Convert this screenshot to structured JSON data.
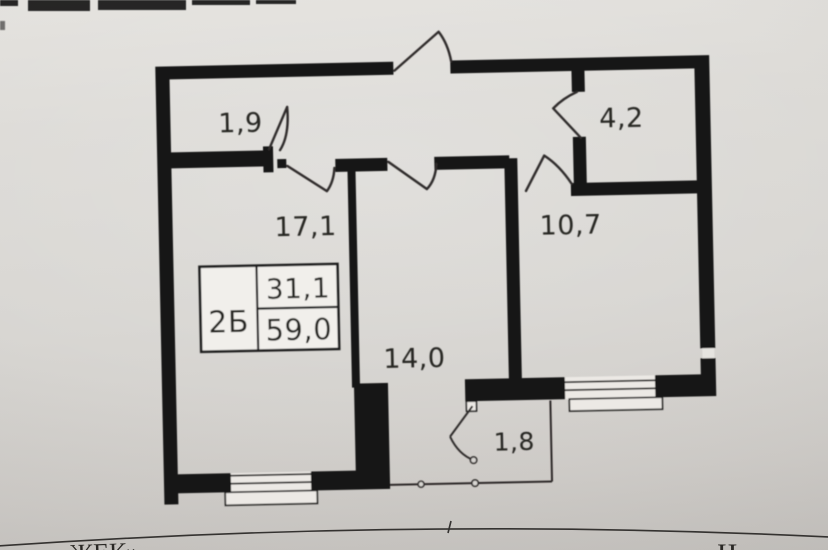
{
  "floorplan": {
    "unit": {
      "label": "2Б",
      "area_living": "31,1",
      "area_total": "59,0"
    },
    "rooms": {
      "storage": "1,9",
      "wardrobe": "4,2",
      "living": "17,1",
      "bedroom": "10,7",
      "kitchen": "14,0",
      "balcony": "1,8"
    },
    "page_text": {
      "bottom_left": "ЖЕК»",
      "bottom_right": "«Чи"
    },
    "colors": {
      "wall": "#161616",
      "paper": "#d8d6d2",
      "ink": "#2e2c2a"
    }
  }
}
